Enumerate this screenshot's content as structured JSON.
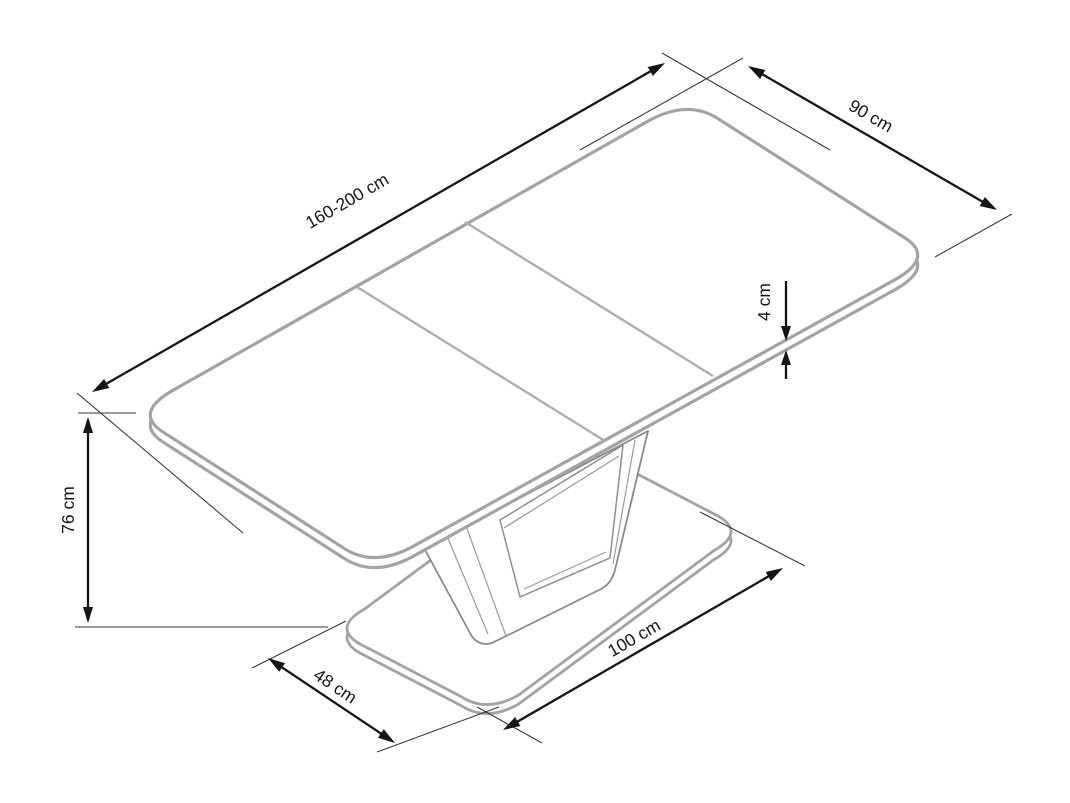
{
  "diagram": {
    "type": "furniture-dimension-drawing",
    "subject": "extendable-dining-table-isometric-view",
    "background_color": "#ffffff",
    "outline_color": "#a3a3a3",
    "dimension_color": "#151515",
    "labels": {
      "length": "160-200 cm",
      "width": "90 cm",
      "thickness": "4 cm",
      "height": "76 cm",
      "base_width": "48 cm",
      "base_length": "100 cm"
    }
  }
}
